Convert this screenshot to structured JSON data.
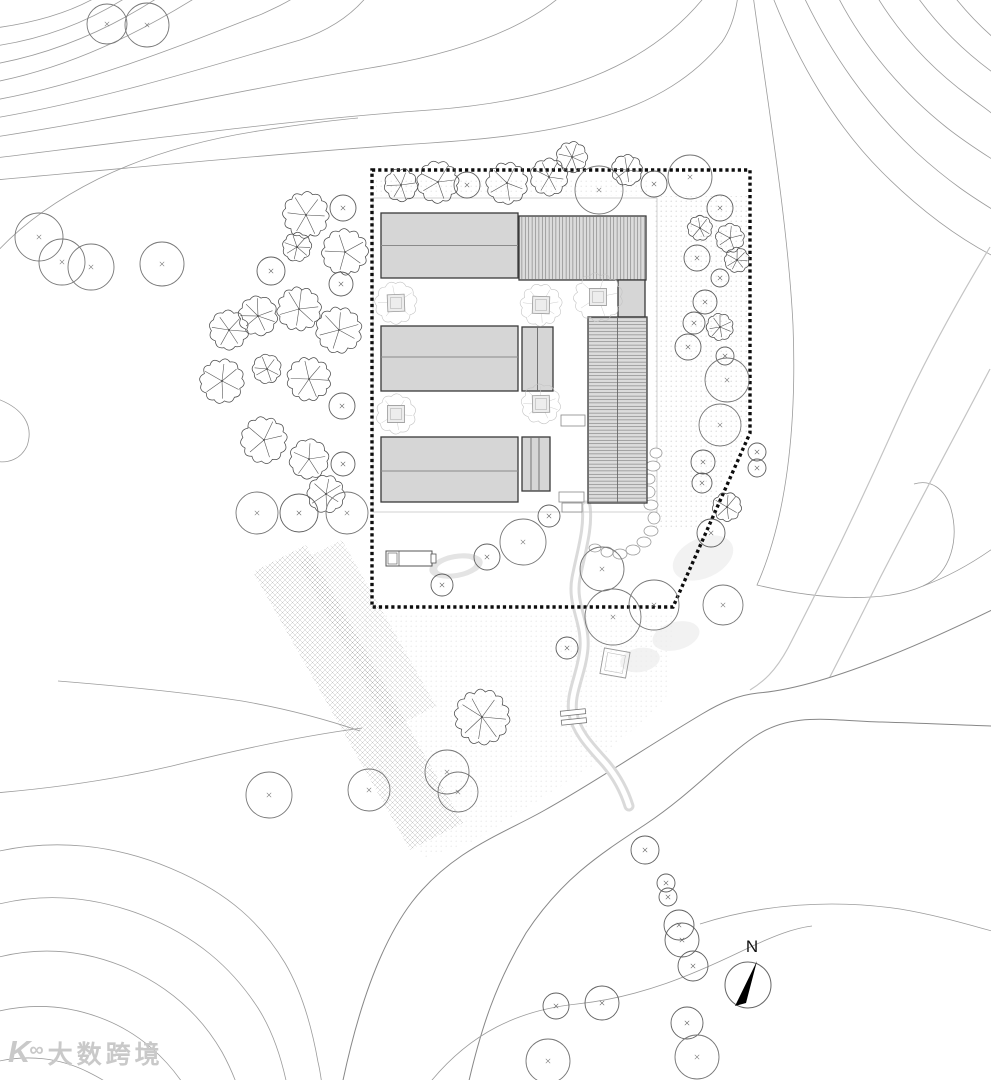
{
  "watermark": {
    "logo_k": "K",
    "logo_oo": "∞",
    "text": "大数跨境"
  },
  "compass": {
    "label": "N",
    "cx": 748,
    "cy": 985,
    "r": 23,
    "needle": "757,961 735,1006 746,1003",
    "label_x": 752,
    "label_y": 952
  },
  "colors": {
    "paper": "#ffffff",
    "contour": "#9b9b9b",
    "contour_light": "#c4c4c4",
    "road_edge": "#878787",
    "boundary": "#0d0d0d",
    "building_fill": "#d6d6d6",
    "building_fill_hatch": "#dcdcdc",
    "building_stroke": "#3a3a3a",
    "tree_dark": "#4a4a4a",
    "tree_mid": "#5f5f5f",
    "tree_faint": "#c3c3c3",
    "stream": "#dadada",
    "texture": "#9f9f9f",
    "pad": "#cccccc",
    "stone": "#9a9a9a",
    "furniture": "#555555",
    "shrub": "#ededed",
    "pond": "#e4e4e4"
  },
  "boundary": {
    "points": "372,170 750,170 750,433 673,607 372,607"
  },
  "pad": {
    "x": 373,
    "y": 198,
    "w": 284,
    "h": 314
  },
  "buildings": [
    {
      "id": "barn-nw",
      "x": 381,
      "y": 213,
      "w": 137,
      "h": 65,
      "roof": "gable",
      "ridge_y": 245.5
    },
    {
      "id": "barn-ne",
      "x": 519,
      "y": 216,
      "w": 127,
      "h": 64,
      "roof": "hatch-v"
    },
    {
      "id": "link-e",
      "x": 618,
      "y": 280,
      "w": 27,
      "h": 37,
      "roof": "flat"
    },
    {
      "id": "barn-w",
      "x": 381,
      "y": 326,
      "w": 137,
      "h": 65,
      "roof": "gable",
      "ridge_y": 357
    },
    {
      "id": "hall-c",
      "x": 522,
      "y": 327,
      "w": 31,
      "h": 64,
      "roof": "flat",
      "vlines": [
        537.5
      ]
    },
    {
      "id": "wing-e",
      "x": 588,
      "y": 317,
      "w": 59,
      "h": 186,
      "roof": "hatch-h",
      "vlines": [
        617.5
      ]
    },
    {
      "id": "barn-sw",
      "x": 381,
      "y": 437,
      "w": 137,
      "h": 65,
      "roof": "gable",
      "ridge_y": 471
    },
    {
      "id": "hall-s",
      "x": 522,
      "y": 437,
      "w": 28,
      "h": 54,
      "roof": "flat",
      "vlines": [
        531,
        539
      ]
    }
  ],
  "steps": [
    [
      561,
      415,
      24,
      11
    ],
    [
      559,
      492,
      25,
      10
    ],
    [
      562,
      503,
      20,
      9
    ]
  ],
  "bench": {
    "x": 386,
    "y": 551,
    "w": 46,
    "h": 15
  },
  "plaza": {
    "cx": 615,
    "cy": 663,
    "size": 26,
    "angle": 10
  },
  "bridge": {
    "cx": 573,
    "cy": 717,
    "angle": -6
  },
  "stepping_stones": [
    [
      656,
      453,
      6,
      5
    ],
    [
      653,
      466,
      7,
      5
    ],
    [
      649,
      479,
      6,
      5
    ],
    [
      648,
      492,
      7,
      6
    ],
    [
      651,
      505,
      7,
      5
    ],
    [
      654,
      518,
      6,
      6
    ],
    [
      651,
      531,
      7,
      5
    ],
    [
      644,
      542,
      7,
      5
    ],
    [
      633,
      550,
      7,
      5
    ],
    [
      620,
      554,
      7,
      5
    ],
    [
      607,
      552,
      6,
      5
    ],
    [
      595,
      548,
      6,
      4
    ]
  ],
  "shrubs": [
    [
      703,
      558,
      32,
      20,
      -25
    ],
    [
      676,
      636,
      24,
      14,
      -15
    ],
    [
      640,
      660,
      20,
      12,
      -10
    ]
  ],
  "pond": {
    "cx": 456,
    "cy": 566,
    "rx": 27,
    "ry": 12,
    "angle": -10
  },
  "stream": "M 586,506 C 589,528 581,552 576,578 C 571,604 586,622 584,648 C 582,674 569,694 573,714 C 577,734 593,749 606,764 C 617,777 624,790 629,806",
  "stairs": {
    "main": "253,572 306,545 463,823 410,850",
    "dark": "298,562 342,540 436,706 390,730"
  },
  "textures": {
    "garden": "362,612 674,612 666,700 590,768 472,842 424,858 384,782 362,706",
    "gravel_east": "652,196 748,196 748,430 700,528 656,528",
    "gravel_north": "376,180 648,180 648,196 376,196"
  },
  "contours_under": [
    "M -5,28 C 40,22 75,10 100,-5",
    "M -5,46 C 50,38 95,18 130,-5",
    "M -5,64 C 60,52 115,26 162,-5",
    "M -5,82 C 70,67 138,34 200,-5",
    "M -5,100 C 85,84 175,48 262,14 C 275,8 288,2 298,-5",
    "M -5,118 C 100,100 205,68 300,40 C 330,30 352,15 368,-5",
    "M -5,137 C 120,118 250,88 370,68 C 450,55 520,32 562,-5",
    "M -5,158 C 140,140 290,120 430,110 C 555,101 648,68 706,-5",
    "M -5,180 C 150,166 320,150 430,143 C 570,134 665,112 722,42 C 731,29 736,12 738,-5",
    "M -5,254 C 22,224 58,199 98,179 C 145,156 200,140 258,131 C 290,126 325,121 358,118",
    "M -5,398 C 24,408 34,426 27,446 C 21,459 8,464 -5,461",
    "M 58,681 C 120,686 182,692 242,701 C 282,708 322,718 360,731",
    "M -5,793 C 55,788 112,780 172,766 C 232,751 302,736 362,728",
    "M -5,852 C 55,838 115,845 170,868 C 230,893 262,925 285,963 C 302,992 312,1028 318,1062 C 320,1070 321,1078 322,1085",
    "M -5,905 C 45,892 95,897 142,915 C 196,936 232,968 258,1008 C 272,1030 281,1056 287,1085",
    "M -5,958 C 40,946 82,950 122,966 C 168,985 200,1014 222,1052 C 228,1063 233,1074 237,1085",
    "M -5,1012 C 35,1002 72,1006 106,1020 C 140,1034 166,1058 184,1085",
    "M -5,1062 C 28,1054 60,1058 88,1072 C 96,1076 104,1080 110,1085",
    "M 753,-5 C 768,105 788,225 793,325 C 797,428 786,520 757,585 C 820,600 885,603 923,586 C 952,573 959,538 951,509 C 945,488 930,479 914,484",
    "M 923,586 C 950,576 974,562 995,547",
    "M 772,-5 C 798,62 835,125 882,172 C 925,215 962,240 995,257",
    "M 803,-5 C 830,52 868,107 916,152 C 950,183 974,198 995,211",
    "M 837,-5 C 863,46 902,92 946,127 C 965,142 981,152 995,161",
    "M 876,-5 C 902,38 936,72 970,97 C 979,104 988,110 995,116",
    "M 916,-5 C 938,26 963,51 995,74",
    "M 953,-5 C 968,14 982,28 995,39"
  ],
  "band": [
    "M 990,247 C 955,305 922,365 893,430 C 855,515 818,590 788,648 C 775,672 763,682 750,690",
    "M 990,369 C 955,436 917,506 880,578 C 858,622 840,658 822,692"
  ],
  "road": {
    "fill": "M 342,1085 C 356,1018 377,948 412,902 C 452,850 505,833 545,810 C 595,782 645,748 702,714 C 722,702 739,695 758,693 C 822,688 922,644 992,610 L 992,726 C 962,725 922,723 882,722 C 832,721 792,711 754,737 C 722,759 691,794 646,824 C 602,853 562,878 526,933 C 496,983 481,1028 468,1085 Z",
    "edges": [
      "M 342,1085 C 356,1018 377,948 412,902 C 452,850 505,833 545,810 C 595,782 645,748 702,714 C 722,702 739,695 758,693 C 822,688 922,644 992,610",
      "M 468,1085 C 481,1028 496,983 526,933 C 562,878 602,853 646,824 C 691,794 722,759 754,737 C 792,711 832,721 882,722 C 922,723 962,725 992,726"
    ]
  },
  "contours_over": [
    "M 428,1085 C 470,1032 520,1010 577,1004 C 642,997 694,974 742,951 C 775,935 795,928 812,926",
    "M 700,924 C 762,904 832,899 900,909 C 936,915 966,924 992,931"
  ],
  "faint_trees": [
    [
      396,
      303,
      20
    ],
    [
      541,
      305,
      20
    ],
    [
      598,
      297,
      23
    ],
    [
      396,
      414,
      19
    ],
    [
      541,
      404,
      19
    ]
  ],
  "trees": [
    [
      306,
      215,
      22,
      "s"
    ],
    [
      343,
      208,
      13,
      "c"
    ],
    [
      297,
      247,
      14,
      "s"
    ],
    [
      345,
      252,
      22,
      "s"
    ],
    [
      271,
      271,
      14,
      "c"
    ],
    [
      341,
      284,
      12,
      "c"
    ],
    [
      299,
      309,
      21,
      "s"
    ],
    [
      258,
      316,
      19,
      "s"
    ],
    [
      229,
      330,
      19,
      "s"
    ],
    [
      339,
      330,
      22,
      "s"
    ],
    [
      222,
      381,
      21,
      "s"
    ],
    [
      267,
      369,
      14,
      "s"
    ],
    [
      309,
      379,
      21,
      "s"
    ],
    [
      342,
      406,
      13,
      "c"
    ],
    [
      264,
      440,
      22,
      "s"
    ],
    [
      309,
      459,
      19,
      "s"
    ],
    [
      343,
      464,
      12,
      "c"
    ],
    [
      326,
      494,
      18,
      "s"
    ],
    [
      257,
      513,
      21,
      "c"
    ],
    [
      299,
      513,
      19,
      "c"
    ],
    [
      347,
      513,
      21,
      "c"
    ],
    [
      401,
      185,
      16,
      "s"
    ],
    [
      438,
      182,
      20,
      "s"
    ],
    [
      467,
      185,
      13,
      "c"
    ],
    [
      507,
      183,
      20,
      "s"
    ],
    [
      549,
      177,
      18,
      "s"
    ],
    [
      572,
      157,
      15,
      "s"
    ],
    [
      599,
      190,
      24,
      "c"
    ],
    [
      627,
      170,
      15,
      "s"
    ],
    [
      654,
      184,
      13,
      "c"
    ],
    [
      690,
      177,
      22,
      "c"
    ],
    [
      720,
      208,
      13,
      "c"
    ],
    [
      700,
      228,
      12,
      "s"
    ],
    [
      730,
      238,
      14,
      "s"
    ],
    [
      697,
      258,
      13,
      "c"
    ],
    [
      737,
      260,
      12,
      "s"
    ],
    [
      720,
      278,
      9,
      "c"
    ],
    [
      705,
      302,
      12,
      "c"
    ],
    [
      694,
      323,
      11,
      "c"
    ],
    [
      720,
      327,
      13,
      "s"
    ],
    [
      688,
      347,
      13,
      "c"
    ],
    [
      725,
      356,
      9,
      "c"
    ],
    [
      727,
      380,
      22,
      "c"
    ],
    [
      720,
      425,
      21,
      "c"
    ],
    [
      703,
      462,
      12,
      "c"
    ],
    [
      702,
      483,
      10,
      "c"
    ],
    [
      727,
      507,
      14,
      "s"
    ],
    [
      711,
      533,
      14,
      "c"
    ],
    [
      757,
      452,
      9,
      "c"
    ],
    [
      757,
      468,
      9,
      "c"
    ],
    [
      549,
      516,
      11,
      "c"
    ],
    [
      523,
      542,
      23,
      "c"
    ],
    [
      487,
      557,
      13,
      "c"
    ],
    [
      602,
      569,
      22,
      "c"
    ],
    [
      442,
      585,
      11,
      "c"
    ],
    [
      654,
      605,
      25,
      "c"
    ],
    [
      613,
      617,
      28,
      "c"
    ],
    [
      723,
      605,
      20,
      "c"
    ],
    [
      567,
      648,
      11,
      "c"
    ],
    [
      482,
      717,
      26,
      "s"
    ],
    [
      447,
      772,
      22,
      "c"
    ],
    [
      458,
      792,
      20,
      "c"
    ],
    [
      369,
      790,
      21,
      "c"
    ],
    [
      269,
      795,
      23,
      "c"
    ],
    [
      645,
      850,
      14,
      "c"
    ],
    [
      666,
      883,
      9,
      "c"
    ],
    [
      668,
      897,
      9,
      "c"
    ],
    [
      679,
      925,
      15,
      "c"
    ],
    [
      682,
      940,
      17,
      "c"
    ],
    [
      693,
      966,
      15,
      "c"
    ],
    [
      556,
      1006,
      13,
      "c"
    ],
    [
      602,
      1003,
      17,
      "c"
    ],
    [
      548,
      1061,
      22,
      "c"
    ],
    [
      687,
      1023,
      16,
      "c"
    ],
    [
      697,
      1057,
      22,
      "c"
    ],
    [
      107,
      24,
      20,
      "c"
    ],
    [
      147,
      25,
      22,
      "c"
    ],
    [
      39,
      237,
      24,
      "c"
    ],
    [
      62,
      262,
      23,
      "c"
    ],
    [
      91,
      267,
      23,
      "c"
    ],
    [
      162,
      264,
      22,
      "c"
    ]
  ]
}
